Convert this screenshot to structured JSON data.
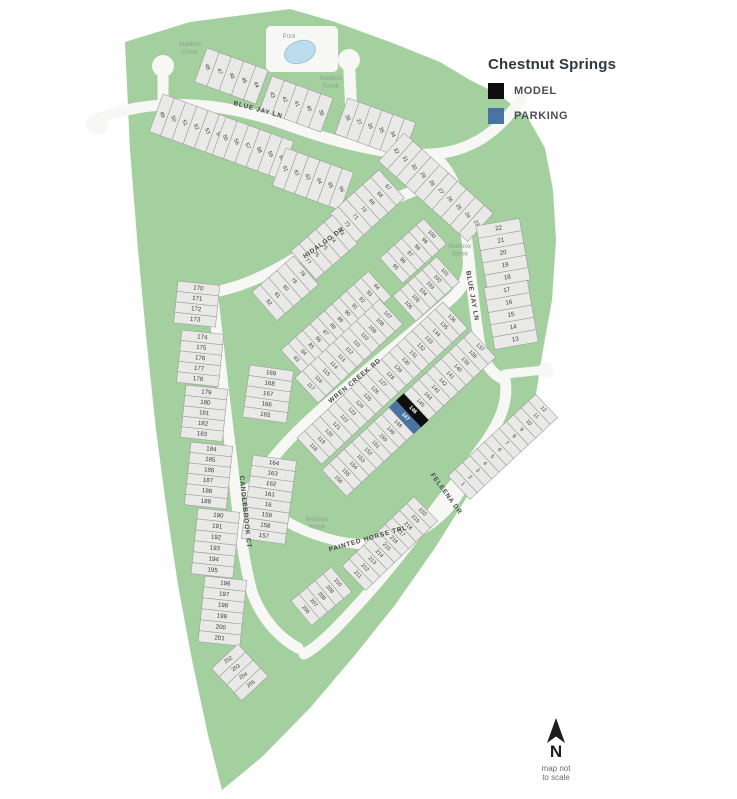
{
  "legend": {
    "title": "Chestnut Springs",
    "items": [
      {
        "key": "model",
        "label": "MODEL",
        "color": "#0e0e0e"
      },
      {
        "key": "parking",
        "label": "PARKING",
        "color": "#4a73a4"
      }
    ]
  },
  "compass": {
    "letter": "N",
    "note1": "map not",
    "note2": "to scale"
  },
  "map": {
    "colors": {
      "green": "#a4cf9f",
      "road": "#f7f7f5",
      "lot_fill": "#e9e9e7",
      "lot_stroke": "#9e9e9b",
      "lot_text": "#3d3d3d",
      "street_text": "#474747",
      "poi_text": "#8fa28c",
      "model": "#0e0e0e",
      "parking": "#4a73a4",
      "special_text": "#ffffff",
      "pool_fill": "#badcec",
      "pool_stroke": "#9fc6da"
    },
    "boundary": [
      [
        125,
        42
      ],
      [
        190,
        22
      ],
      [
        290,
        9
      ],
      [
        335,
        22
      ],
      [
        390,
        42
      ],
      [
        440,
        62
      ],
      [
        470,
        80
      ],
      [
        500,
        95
      ],
      [
        528,
        118
      ],
      [
        545,
        148
      ],
      [
        553,
        190
      ],
      [
        556,
        240
      ],
      [
        552,
        300
      ],
      [
        543,
        350
      ],
      [
        535,
        400
      ],
      [
        508,
        442
      ],
      [
        470,
        492
      ],
      [
        435,
        548
      ],
      [
        395,
        605
      ],
      [
        355,
        655
      ],
      [
        310,
        708
      ],
      [
        262,
        757
      ],
      [
        222,
        790
      ],
      [
        208,
        735
      ],
      [
        192,
        660
      ],
      [
        178,
        585
      ],
      [
        166,
        505
      ],
      [
        156,
        430
      ],
      [
        147,
        345
      ],
      [
        138,
        250
      ],
      [
        130,
        150
      ]
    ],
    "roads": [
      {
        "name": "blue-jay-ln-top",
        "w": 11,
        "d": "M 94,120 C 160,94 230,104 290,126 C 340,144 390,156 432,154 C 468,152 492,134 508,116 C 514,109 518,104 522,98"
      },
      {
        "name": "blue-jay-ln-east",
        "w": 11,
        "d": "M 432,154 C 452,170 460,194 465,224 C 469,258 473,300 479,340 C 483,362 491,374 505,380"
      },
      {
        "name": "east-stub",
        "w": 9,
        "d": "M 505,374 L 544,370"
      },
      {
        "name": "hidalgo-dr",
        "w": 11,
        "d": "M 214,292 C 248,286 282,268 320,242 C 358,216 396,196 428,186 C 446,180 456,184 462,194"
      },
      {
        "name": "wren-creek-rd",
        "w": 11,
        "d": "M 264,470 C 284,442 312,416 346,388 C 383,356 420,326 452,298 C 465,286 470,272 468,256"
      },
      {
        "name": "wren-painted-connector",
        "w": 9,
        "d": "M 264,470 C 258,480 252,486 246,490"
      },
      {
        "name": "painted-horse-trl",
        "w": 10,
        "d": "M 246,490 C 272,516 298,530 326,538 C 360,548 392,546 418,532 C 440,520 454,504 462,488"
      },
      {
        "name": "feleena-dr",
        "w": 11,
        "d": "M 505,380 C 509,402 499,424 482,447 C 460,477 438,505 414,537 C 390,569 362,601 336,628 C 322,642 312,650 304,654"
      },
      {
        "name": "candlebrook-ct",
        "w": 11,
        "d": "M 212,290 C 218,340 224,400 232,460 C 238,515 242,555 252,592 C 260,615 276,636 298,648"
      },
      {
        "name": "entry-stub",
        "w": 11,
        "d": "M 163,70 L 163,116"
      },
      {
        "name": "kiosk-driveway",
        "w": 12,
        "d": "M 349,62 L 351,104"
      }
    ],
    "pads": [
      {
        "name": "entry-bulb",
        "type": "circle",
        "x": 97,
        "y": 124,
        "r": 11
      },
      {
        "name": "entry-kiosk-bulb",
        "type": "circle",
        "x": 163,
        "y": 66,
        "r": 11
      },
      {
        "name": "kiosk-bulb-north",
        "type": "circle",
        "x": 349,
        "y": 60,
        "r": 11
      },
      {
        "name": "east-stub-bulb",
        "type": "circle",
        "x": 546,
        "y": 370,
        "r": 8
      },
      {
        "name": "pool-pad",
        "type": "rect",
        "x": 266,
        "y": 26,
        "w": 72,
        "h": 46,
        "rx": 5
      }
    ],
    "pool": {
      "cx": 300,
      "cy": 52,
      "rx": 16,
      "ry": 11,
      "rotate": -20
    },
    "street_labels": [
      {
        "name": "blue-jay-ln-top",
        "text": "BLUE JAY LN",
        "x": 258,
        "y": 110,
        "rotate": 15
      },
      {
        "name": "blue-jay-ln-east",
        "text": "BLUE JAY LN",
        "x": 472,
        "y": 296,
        "rotate": 80
      },
      {
        "name": "hidalgo-dr",
        "text": "HIDALGO DR",
        "x": 324,
        "y": 243,
        "rotate": -36
      },
      {
        "name": "wren-creek-rd",
        "text": "WREN CREEK RD",
        "x": 355,
        "y": 381,
        "rotate": -40
      },
      {
        "name": "candlebrook-ct",
        "text": "CANDLEBROOK CT",
        "x": 245,
        "y": 512,
        "rotate": 84
      },
      {
        "name": "painted-horse-trl",
        "text": "PAINTED HORSE TRL",
        "x": 368,
        "y": 539,
        "rotate": -16
      },
      {
        "name": "feleena-dr",
        "text": "FELEENA DR",
        "x": 446,
        "y": 494,
        "rotate": 54
      }
    ],
    "poi_labels": [
      {
        "name": "mailbox-kiosk-northwest",
        "lines": [
          "Mailbox",
          "Kiosk"
        ],
        "x": 190,
        "y": 46
      },
      {
        "name": "mailbox-kiosk-north",
        "lines": [
          "Mailbox",
          "Kiosk"
        ],
        "x": 331,
        "y": 80
      },
      {
        "name": "mailbox-kiosk-east",
        "lines": [
          "Mailbox",
          "Kiosk"
        ],
        "x": 460,
        "y": 248
      },
      {
        "name": "mailbox-kiosk-south",
        "lines": [
          "Mailbox",
          "Kiosk"
        ],
        "x": 317,
        "y": 521
      },
      {
        "name": "pool",
        "lines": [
          "Pool"
        ],
        "x": 289,
        "y": 38
      }
    ],
    "lot_groups": [
      {
        "name": "lots-48-44",
        "type": "row",
        "x": 207,
        "y": 48,
        "angle": 20,
        "w": 13,
        "h": 36,
        "nrot": 48,
        "numbers": [
          "48",
          "47",
          "46",
          "45",
          "44"
        ]
      },
      {
        "name": "lots-43-39",
        "type": "row",
        "x": 272,
        "y": 76,
        "angle": 20,
        "w": 13,
        "h": 36,
        "nrot": 48,
        "numbers": [
          "43",
          "42",
          "41",
          "40",
          "39"
        ]
      },
      {
        "name": "lots-49-54",
        "type": "row",
        "x": 163,
        "y": 94,
        "angle": 20,
        "w": 12,
        "h": 40,
        "nrot": 48,
        "numbers": [
          "49",
          "50",
          "51",
          "52",
          "53",
          "54"
        ]
      },
      {
        "name": "lots-55-60",
        "type": "row",
        "x": 226,
        "y": 117,
        "angle": 20,
        "w": 12,
        "h": 40,
        "nrot": 48,
        "numbers": [
          "55",
          "56",
          "57",
          "58",
          "59",
          "60"
        ]
      },
      {
        "name": "lots-61-66",
        "type": "row",
        "x": 286,
        "y": 148,
        "angle": 20,
        "w": 12,
        "h": 40,
        "nrot": 48,
        "numbers": [
          "61",
          "62",
          "63",
          "64",
          "65",
          "66"
        ]
      },
      {
        "name": "lots-38-33",
        "type": "row",
        "x": 348,
        "y": 98,
        "angle": 20,
        "w": 12,
        "h": 38,
        "nrot": 48,
        "numbers": [
          "38",
          "37",
          "36",
          "35",
          "34",
          "33"
        ]
      },
      {
        "name": "lots-32-23",
        "type": "row",
        "x": 404,
        "y": 133,
        "angle": 42,
        "w": 12,
        "h": 38,
        "nrot": 20,
        "numbers": [
          "32",
          "31",
          "30",
          "29",
          "28",
          "27",
          "26",
          "25",
          "24",
          "23"
        ]
      },
      {
        "name": "lots-22-18",
        "type": "stack",
        "x": 476,
        "y": 226,
        "angle": -10,
        "w": 44,
        "h": 12.5,
        "numbers": [
          "22",
          "21",
          "20",
          "19",
          "18"
        ]
      },
      {
        "name": "lots-17-13",
        "type": "stack",
        "x": 484,
        "y": 288,
        "angle": -10,
        "w": 44,
        "h": 12.5,
        "numbers": [
          "17",
          "16",
          "15",
          "14",
          "13"
        ]
      },
      {
        "name": "lots-72-67",
        "type": "row",
        "x": 330,
        "y": 214,
        "angle": -42,
        "w": 11,
        "h": 38,
        "nrot": 90,
        "numbers": [
          "72",
          "71",
          "70",
          "69",
          "68",
          "67"
        ]
      },
      {
        "name": "lots-77-73",
        "type": "row",
        "x": 291,
        "y": 251,
        "angle": -41,
        "w": 11,
        "h": 38,
        "nrot": 90,
        "numbers": [
          "77",
          "76",
          "75",
          "74",
          "73"
        ]
      },
      {
        "name": "lots-82-78",
        "type": "row",
        "x": 252,
        "y": 292,
        "angle": -41,
        "w": 11,
        "h": 38,
        "nrot": 90,
        "numbers": [
          "82",
          "81",
          "80",
          "79",
          "78"
        ]
      },
      {
        "name": "lots-83-94",
        "type": "row",
        "x": 281,
        "y": 350,
        "angle": -42,
        "w": 9.8,
        "h": 34,
        "nrot": 90,
        "numbers": [
          "83",
          "84",
          "85",
          "86",
          "87",
          "88",
          "89",
          "90",
          "91",
          "92",
          "93",
          "94"
        ]
      },
      {
        "name": "lots-95-100",
        "type": "row",
        "x": 380,
        "y": 258,
        "angle": -42,
        "w": 9.8,
        "h": 34,
        "nrot": 90,
        "numbers": [
          "95",
          "96",
          "97",
          "98",
          "99",
          "100"
        ]
      },
      {
        "name": "lots-101-106",
        "type": "row",
        "x": 393,
        "y": 296,
        "angle": -42,
        "w": 9.8,
        "h": 34,
        "nrot": 90,
        "numbers": [
          "106",
          "105",
          "104",
          "103",
          "102",
          "101"
        ]
      },
      {
        "name": "lots-107-117",
        "type": "row",
        "x": 295,
        "y": 378,
        "angle": -43,
        "w": 10.5,
        "h": 34,
        "nrot": 90,
        "numbers": [
          "117",
          "116",
          "115",
          "114",
          "113",
          "112",
          "111",
          "110",
          "109",
          "108",
          "107"
        ]
      },
      {
        "name": "lots-118-136",
        "type": "row",
        "x": 297,
        "y": 438,
        "angle": -43,
        "w": 10.5,
        "h": 36,
        "nrot": 90,
        "numbers": [
          "118",
          "119",
          "120",
          "121",
          "122",
          "123",
          "124",
          "125",
          "126",
          "127",
          "128",
          "129",
          "130",
          "131",
          "132",
          "133",
          "134",
          "135",
          "136"
        ]
      },
      {
        "name": "lots-137-156",
        "type": "row",
        "x": 322,
        "y": 470,
        "angle": -43,
        "w": 10.2,
        "h": 36,
        "nrot": 90,
        "special": {
          "146": "model",
          "147": "parking"
        },
        "numbers": [
          "156",
          "155",
          "154",
          "153",
          "152",
          "151",
          "150",
          "149",
          "148",
          "147",
          "146",
          "145",
          "144",
          "143",
          "142",
          "141",
          "140",
          "139",
          "138",
          "137"
        ]
      },
      {
        "name": "lots-211-220",
        "type": "row",
        "x": 342,
        "y": 566,
        "angle": -44,
        "w": 10,
        "h": 34,
        "nrot": 90,
        "numbers": [
          "211",
          "212",
          "213",
          "214",
          "215",
          "216",
          "217",
          "218",
          "219",
          "220"
        ]
      },
      {
        "name": "lots-206-210",
        "type": "row",
        "x": 291,
        "y": 601,
        "angle": -40,
        "w": 10.5,
        "h": 32,
        "nrot": 90,
        "numbers": [
          "206",
          "207",
          "208",
          "209",
          "210"
        ]
      },
      {
        "name": "lots-1-12",
        "type": "row",
        "x": 448,
        "y": 476,
        "angle": -43,
        "w": 10,
        "h": 32,
        "nrot": 90,
        "numbers": [
          "1",
          "2",
          "3",
          "4",
          "5",
          "6",
          "7",
          "8",
          "9",
          "10",
          "11",
          "12"
        ]
      },
      {
        "name": "lots-169-165",
        "type": "stack",
        "x": 250,
        "y": 365,
        "angle": 8,
        "w": 44,
        "h": 10.5,
        "numbers": [
          "169",
          "168",
          "167",
          "166",
          "165"
        ]
      },
      {
        "name": "lots-164-157",
        "type": "stack",
        "x": 253,
        "y": 455,
        "angle": 8,
        "w": 44,
        "h": 10.5,
        "numbers": [
          "164",
          "163",
          "162",
          "161",
          "16",
          "159",
          "158",
          "157"
        ]
      },
      {
        "name": "lots-170-173",
        "type": "stack",
        "x": 178,
        "y": 281,
        "angle": 6,
        "w": 42,
        "h": 10.5,
        "numbers": [
          "170",
          "171",
          "172",
          "173"
        ]
      },
      {
        "name": "lots-174-178",
        "type": "stack",
        "x": 182,
        "y": 330,
        "angle": 6,
        "w": 42,
        "h": 10.5,
        "numbers": [
          "174",
          "175",
          "176",
          "177",
          "178"
        ]
      },
      {
        "name": "lots-179-183",
        "type": "stack",
        "x": 186,
        "y": 385,
        "angle": 6,
        "w": 42,
        "h": 10.5,
        "numbers": [
          "179",
          "180",
          "181",
          "182",
          "183"
        ]
      },
      {
        "name": "lots-184-189",
        "type": "stack",
        "x": 191,
        "y": 442,
        "angle": 6,
        "w": 42,
        "h": 10.5,
        "numbers": [
          "184",
          "185",
          "186",
          "187",
          "188",
          "189"
        ]
      },
      {
        "name": "lots-190-195",
        "type": "stack",
        "x": 198,
        "y": 508,
        "angle": 6,
        "w": 42,
        "h": 11,
        "numbers": [
          "190",
          "191",
          "192",
          "193",
          "194",
          "195"
        ]
      },
      {
        "name": "lots-196-201",
        "type": "stack",
        "x": 205,
        "y": 576,
        "angle": 6,
        "w": 42,
        "h": 11,
        "numbers": [
          "196",
          "197",
          "198",
          "199",
          "200",
          "201"
        ]
      },
      {
        "name": "lots-202-205",
        "type": "row",
        "x": 238,
        "y": 644,
        "angle": 47,
        "w": 11,
        "h": 36,
        "nrot": -80,
        "numbers": [
          "202",
          "203",
          "204",
          "205"
        ]
      }
    ]
  }
}
